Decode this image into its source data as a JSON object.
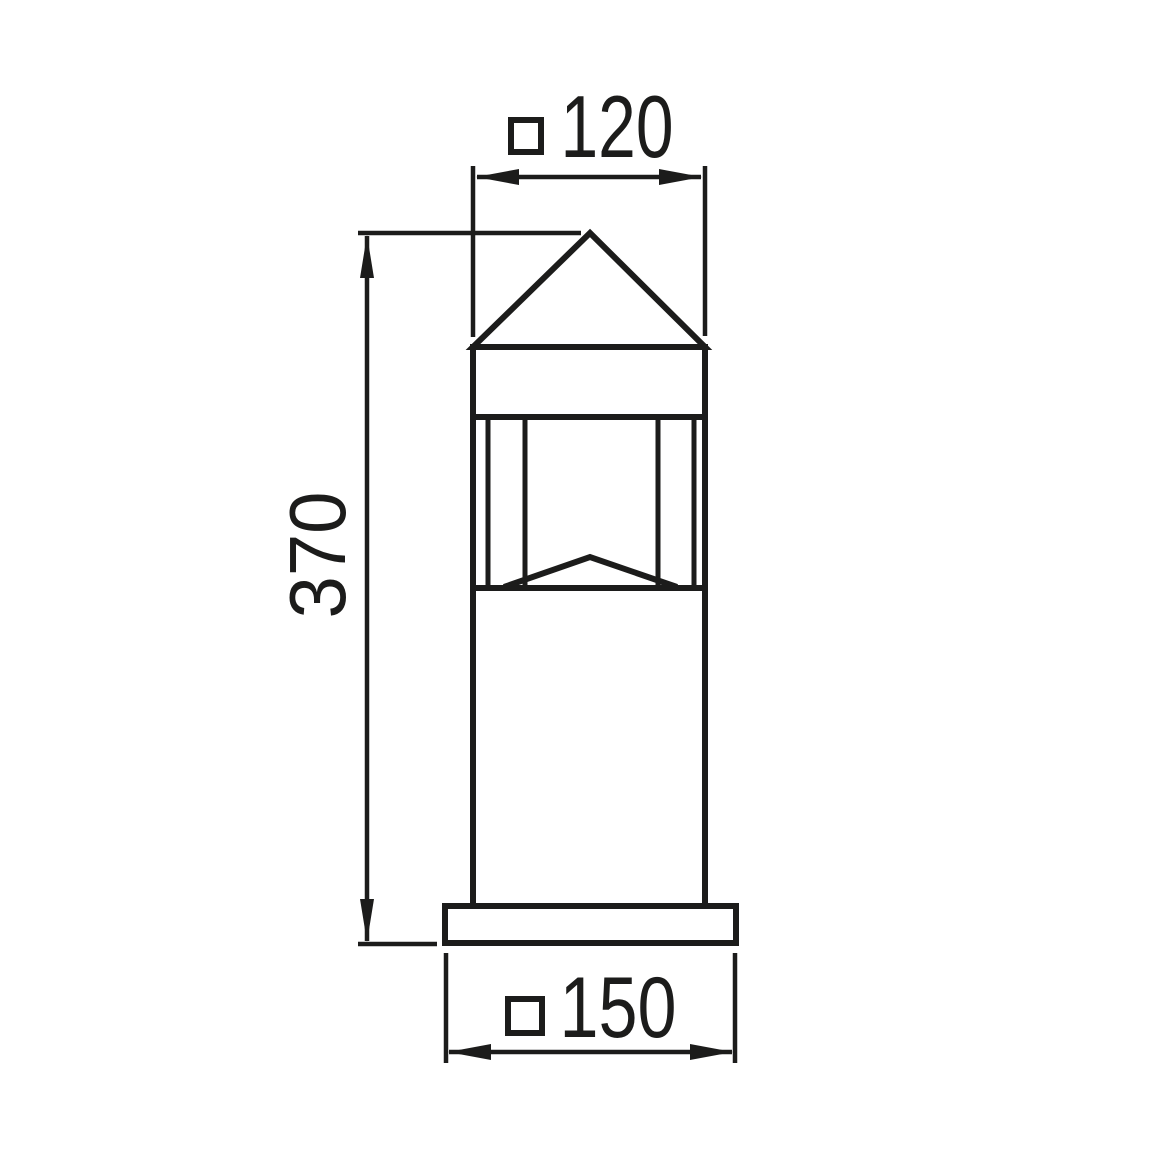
{
  "canvas": {
    "background": "#ffffff",
    "line_color": "#1c1c1b"
  },
  "dimensions": {
    "top_width": {
      "symbol": "□",
      "symbol_name": "square-section-symbol",
      "value": "120"
    },
    "height": {
      "value": "370"
    },
    "base_width": {
      "symbol": "□",
      "symbol_name": "square-section-symbol",
      "value": "150"
    }
  }
}
